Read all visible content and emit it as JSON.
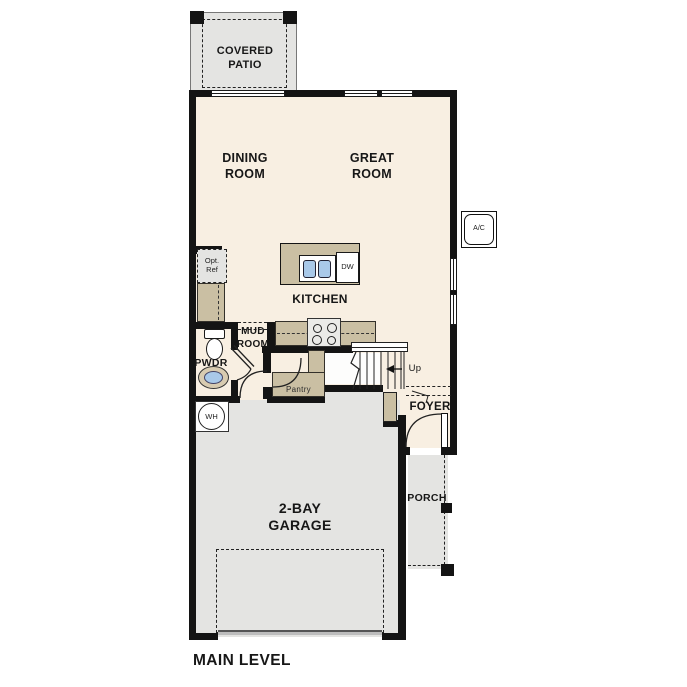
{
  "plan": {
    "title": "MAIN LEVEL",
    "rooms": {
      "covered_patio": "COVERED\nPATIO",
      "dining": "DINING\nROOM",
      "great": "GREAT\nROOM",
      "kitchen": "KITCHEN",
      "mud": "MUD\nROOM",
      "pwdr": "PWDR",
      "pantry": "Pantry",
      "foyer": "FOYER",
      "porch": "PORCH",
      "garage": "2-BAY\nGARAGE"
    },
    "labels": {
      "opt_ref": "Opt.\nRef",
      "up": "Up",
      "dw": "DW",
      "wh": "WH",
      "ac": "A/C"
    },
    "colors": {
      "floor": "#f8efe2",
      "counter": "#cabfa3",
      "concrete": "#e4e4e2",
      "sink_blue": "#a9c9e9",
      "wall": "#141414"
    }
  }
}
